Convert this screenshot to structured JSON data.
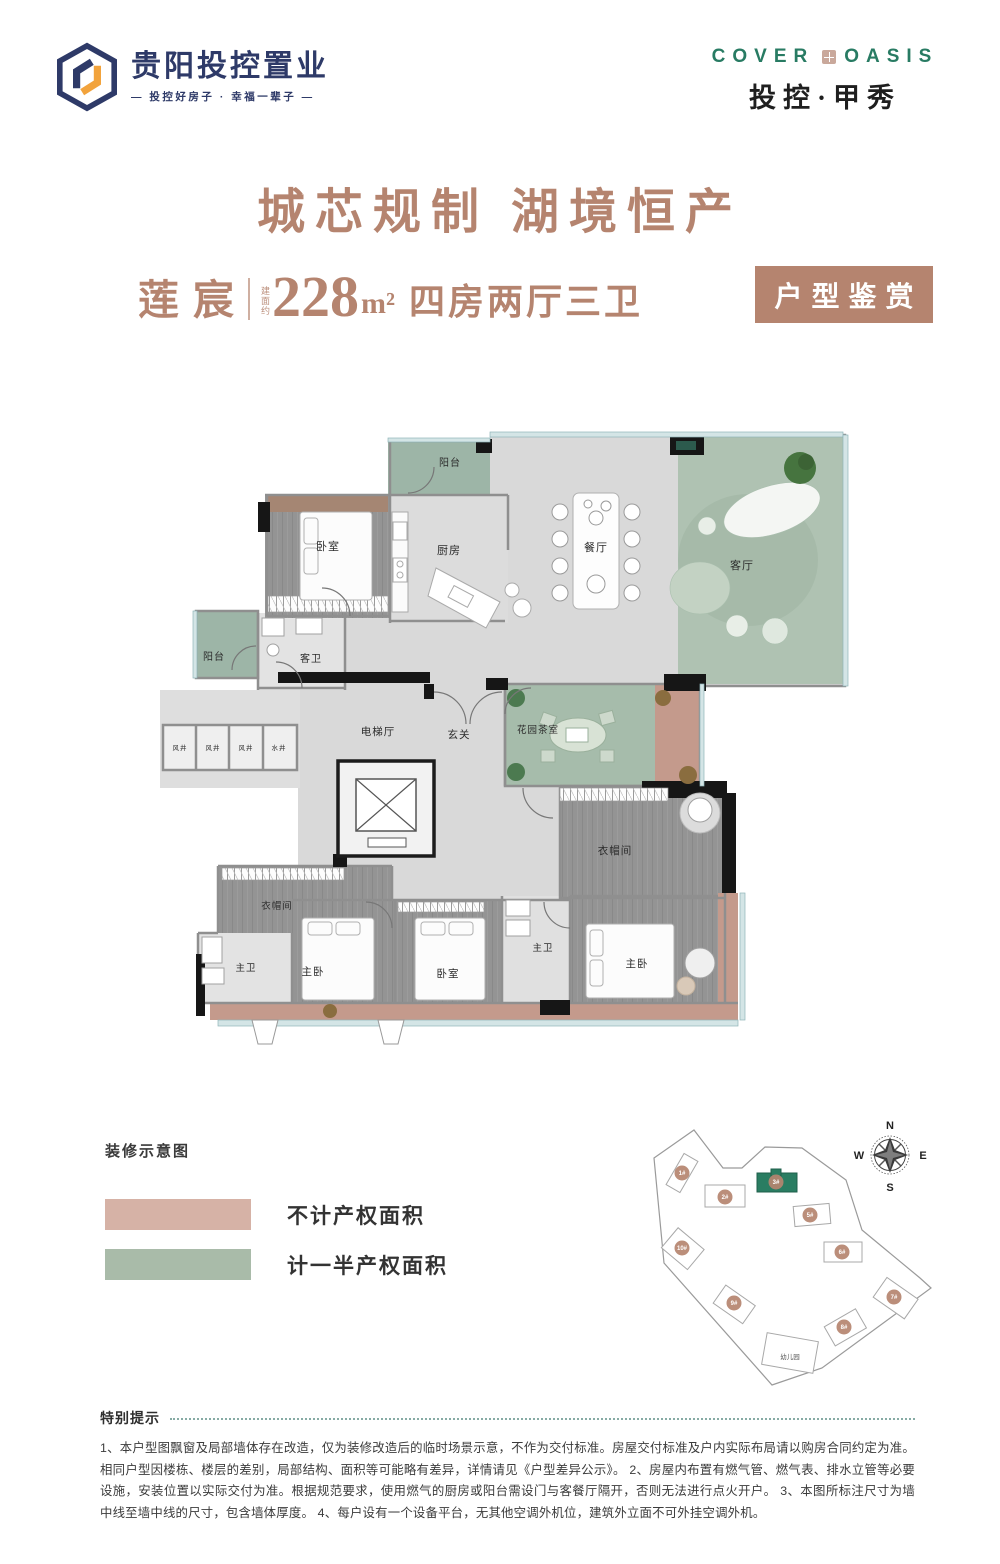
{
  "brand": {
    "logo_name": "贵阳投控置业",
    "logo_tagline": "— 投控好房子 · 幸福一辈子 —",
    "en_left": "COVER",
    "en_right": "OASIS",
    "cn_name": "投控·甲秀"
  },
  "hero": {
    "title": "城芯规制 湖境恒产"
  },
  "unit_bar": {
    "unit_name": "莲宸",
    "area_prefix": "建面约",
    "area_value": "228",
    "area_unit": "m²",
    "layout_desc": "四房两厅三卫",
    "badge": "户型鉴赏"
  },
  "colors": {
    "accent_rose": "#b5846f",
    "brand_green": "#287b63",
    "logo_navy": "#2e3a68",
    "logo_orange": "#f2a33c",
    "area_pink": "#c49a8c",
    "area_green": "#a6bcab"
  },
  "floorplan": {
    "labels": [
      {
        "t": "阳台",
        "x": 450,
        "y": 468,
        "s": 10
      },
      {
        "t": "卧室",
        "x": 328,
        "y": 552,
        "s": 11
      },
      {
        "t": "厨房",
        "x": 449,
        "y": 556,
        "s": 11
      },
      {
        "t": "餐厅",
        "x": 596,
        "y": 553,
        "s": 11
      },
      {
        "t": "客厅",
        "x": 742,
        "y": 571,
        "s": 11
      },
      {
        "t": "阳台",
        "x": 214,
        "y": 662,
        "s": 10
      },
      {
        "t": "客卫",
        "x": 311,
        "y": 664,
        "s": 10
      },
      {
        "t": "风井",
        "x": 180,
        "y": 752,
        "s": 6.5
      },
      {
        "t": "风井",
        "x": 213,
        "y": 752,
        "s": 6.5
      },
      {
        "t": "风井",
        "x": 246,
        "y": 752,
        "s": 6.5
      },
      {
        "t": "水井",
        "x": 279,
        "y": 752,
        "s": 6.5
      },
      {
        "t": "电梯厅",
        "x": 378,
        "y": 737,
        "s": 10.5
      },
      {
        "t": "玄关",
        "x": 459,
        "y": 740,
        "s": 10.5
      },
      {
        "t": "花园茶室",
        "x": 538,
        "y": 735,
        "s": 9.5
      },
      {
        "t": "衣帽间",
        "x": 615,
        "y": 856,
        "s": 10.5
      },
      {
        "t": "衣帽间",
        "x": 277,
        "y": 911,
        "s": 9.5
      },
      {
        "t": "主卫",
        "x": 246,
        "y": 973,
        "s": 9.5
      },
      {
        "t": "主卧",
        "x": 313,
        "y": 977,
        "s": 10.5
      },
      {
        "t": "卧室",
        "x": 448,
        "y": 979,
        "s": 10.5
      },
      {
        "t": "主卫",
        "x": 543,
        "y": 953,
        "s": 9.5
      },
      {
        "t": "主卧",
        "x": 637,
        "y": 969,
        "s": 10.5
      }
    ]
  },
  "legend": {
    "heading": "装修示意图",
    "items": [
      {
        "label": "不计产权面积",
        "color": "#d6b2a6"
      },
      {
        "label": "计一半产权面积",
        "color": "#a9bba9"
      }
    ]
  },
  "sitemap": {
    "buildings": [
      {
        "id": "1#",
        "x": 30,
        "y": 58
      },
      {
        "id": "2#",
        "x": 73,
        "y": 82
      },
      {
        "id": "3#",
        "x": 124,
        "y": 67,
        "main": true
      },
      {
        "id": "5#",
        "x": 158,
        "y": 100
      },
      {
        "id": "6#",
        "x": 190,
        "y": 137
      },
      {
        "id": "10#",
        "x": 30,
        "y": 133
      },
      {
        "id": "9#",
        "x": 82,
        "y": 188
      },
      {
        "id": "8#",
        "x": 192,
        "y": 212
      },
      {
        "id": "7#",
        "x": 242,
        "y": 182
      }
    ],
    "kindergarten": {
      "label": "幼儿园",
      "x": 138,
      "y": 244
    },
    "compass": {
      "n": "N",
      "e": "E",
      "s": "S",
      "w": "W"
    },
    "marker_color": "#b5846f",
    "main_building_color": "#287b63"
  },
  "notice": {
    "heading": "特别提示",
    "body": "1、本户型图飘窗及局部墙体存在改造，仅为装修改造后的临时场景示意，不作为交付标准。房屋交付标准及户内实际布局请以购房合同约定为准。相同户型因楼栋、楼层的差别，局部结构、面积等可能略有差异，详情请见《户型差异公示》。 2、房屋内布置有燃气管、燃气表、排水立管等必要设施，安装位置以实际交付为准。根据规范要求，使用燃气的厨房或阳台需设门与客餐厅隔开，否则无法进行点火开户。 3、本图所标注尺寸为墙中线至墙中线的尺寸，包含墙体厚度。 4、每户设有一个设备平台，无其他空调外机位，建筑外立面不可外挂空调外机。"
  }
}
